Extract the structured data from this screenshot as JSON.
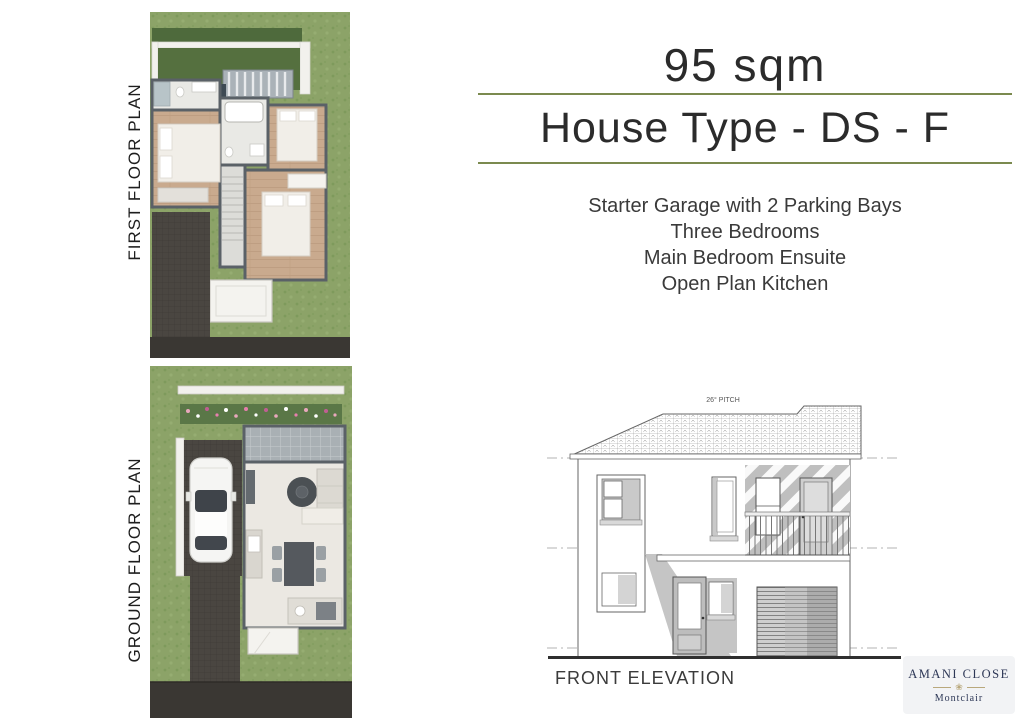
{
  "header": {
    "area": "95 sqm",
    "house_type": "House Type - DS - F"
  },
  "features": [
    "Starter Garage with 2 Parking Bays",
    "Three Bedrooms",
    "Main Bedroom Ensuite",
    "Open Plan Kitchen"
  ],
  "plans": {
    "first_floor_label": "FIRST FLOOR PLAN",
    "ground_floor_label": "GROUND FLOOR PLAN"
  },
  "elevation": {
    "label": "FRONT ELEVATION",
    "pitch_note": "26° PITCH"
  },
  "logo": {
    "name": "AMANI CLOSE",
    "subtitle": "Montclair",
    "flower_icon": "lotus-flower"
  },
  "colors": {
    "divider_green": "#7b8a4f",
    "heading_text": "#2b2b2b",
    "body_text": "#3a3a3a",
    "grass": "#8ca368",
    "paving": "#4a4641",
    "road": "#3a3733",
    "wall_gray": "#5a6167",
    "logo_navy": "#2d3756",
    "logo_gold": "#b9a87c",
    "logo_background": "#f2f3f5"
  }
}
